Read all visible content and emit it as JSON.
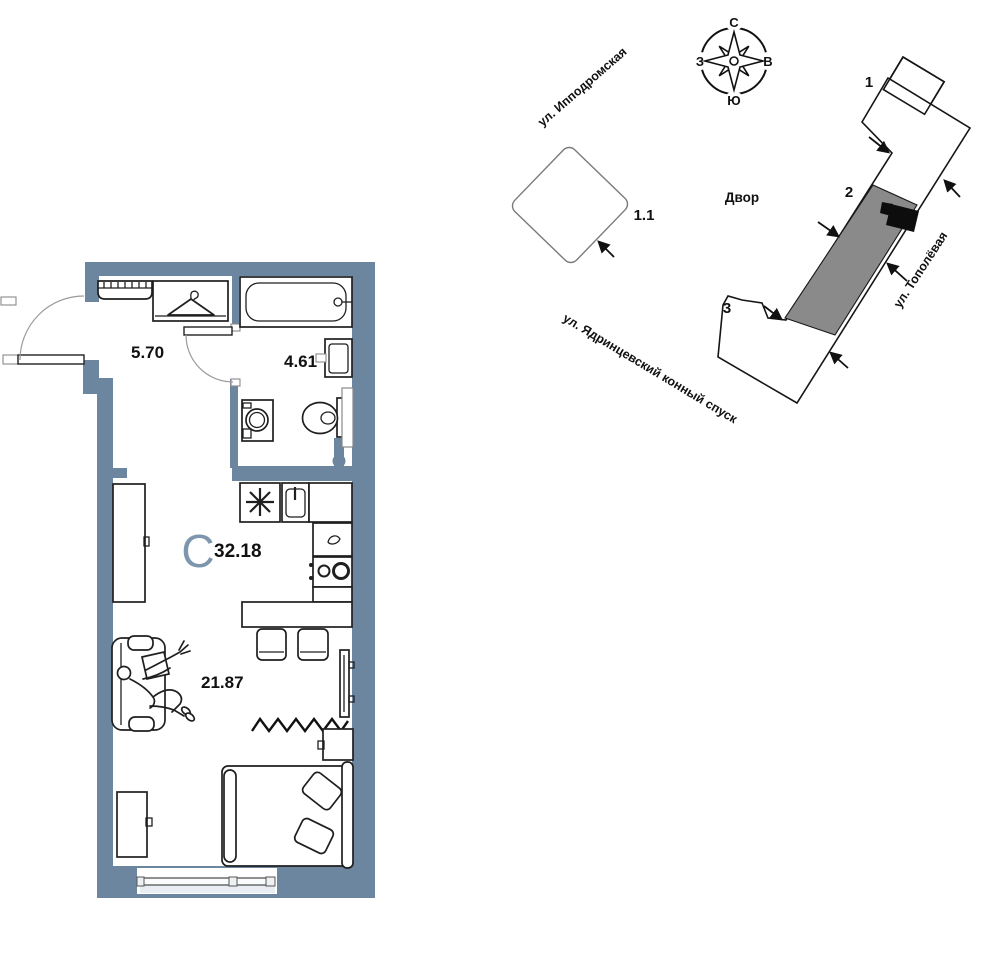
{
  "plan": {
    "north_letter": "С",
    "area_total": "32.18",
    "area_hall": "5.70",
    "area_bathroom": "4.61",
    "area_room": "21.87"
  },
  "map": {
    "courtyard_label": "Двор",
    "block_label": "1.1",
    "sections": {
      "s1": "1",
      "s2": "2",
      "s3": "3"
    },
    "streets": {
      "ippodromskaya": "ул. Ипподромская",
      "yadrintsevsky": "ул. Ядринцевский конный спуск",
      "topolyovaya": "ул. Тополёвая"
    },
    "compass": {
      "north": "С",
      "south": "Ю",
      "west": "З",
      "east": "В"
    }
  },
  "colors": {
    "wall": "#6d86a0",
    "north_letter": "#7e96ad",
    "building_section": "#8a8a8a",
    "apartment_marker": "#0d0d0d",
    "background": "#ffffff"
  }
}
